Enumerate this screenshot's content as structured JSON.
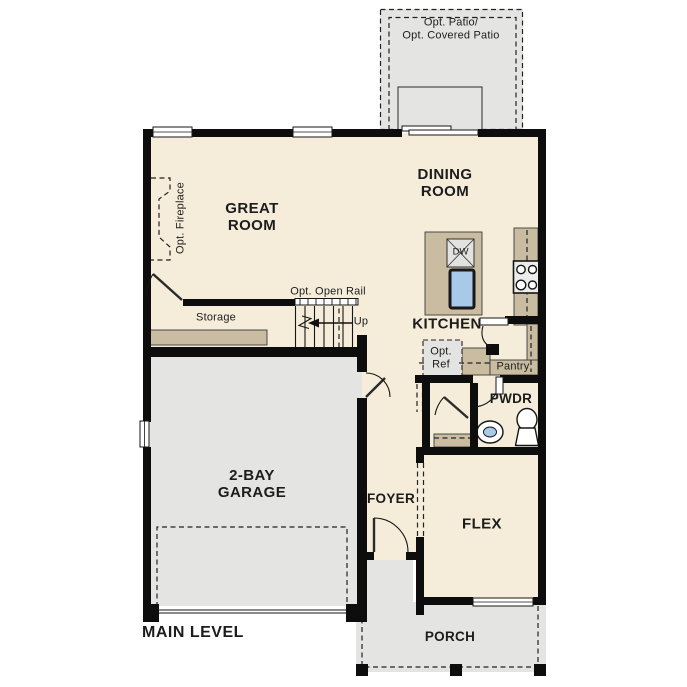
{
  "plan_title": "MAIN LEVEL",
  "rooms": {
    "great_room": "GREAT ROOM",
    "dining_room": "DINING ROOM",
    "kitchen": "KITCHEN",
    "garage": "2-BAY GARAGE",
    "flex": "FLEX",
    "foyer": "FOYER",
    "powder": "PWDR",
    "pantry": "Pantry",
    "storage": "Storage",
    "porch": "PORCH"
  },
  "annotations": {
    "patio_line1": "Opt. Patio/",
    "patio_line2": "Opt. Covered Patio",
    "fireplace": "Opt. Fireplace",
    "open_rail": "Opt. Open Rail",
    "stairs_up": "Up",
    "ref_line1": "Opt.",
    "ref_line2": "Ref",
    "dishwasher": "DW"
  },
  "colors": {
    "floor": "#f5edda",
    "concrete": "#e4e4e2",
    "counter": "#c9bca1",
    "sink": "#a9c9e9",
    "wall": "#0d0d0d"
  }
}
